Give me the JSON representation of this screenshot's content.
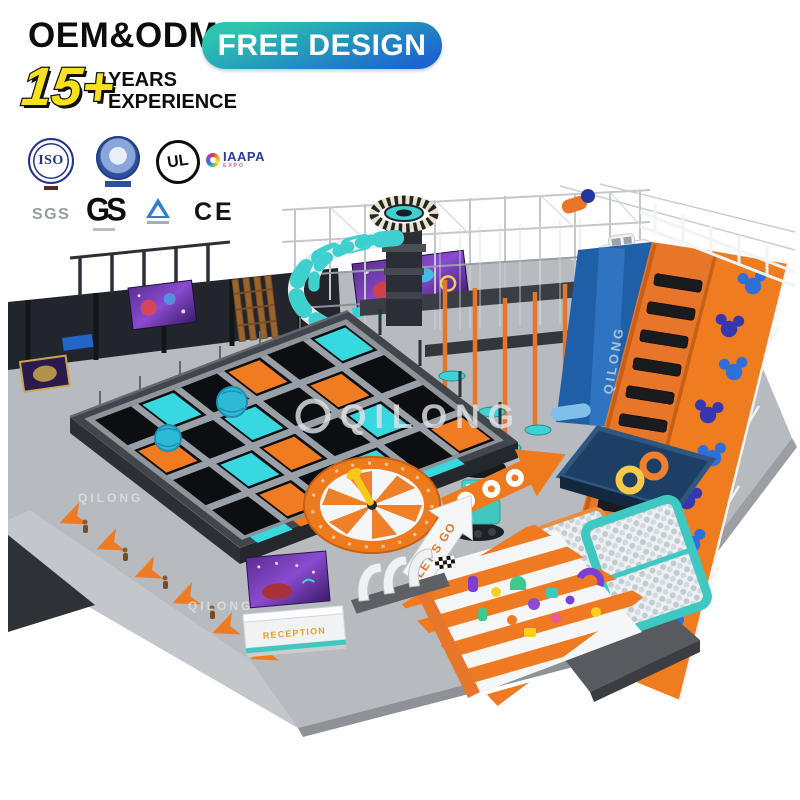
{
  "header": {
    "oem_odm": "OEM&ODM",
    "free_design": "FREE DESIGN",
    "years_number": "15+",
    "years_word": "YEARS",
    "experience_word": "EXPERIENCE",
    "pill_gradient_start": "#2cc4ae",
    "pill_gradient_end": "#1e66cf",
    "years_number_color": "#f6e11c"
  },
  "certifications": {
    "row1": [
      {
        "id": "iso",
        "label": "ISO"
      },
      {
        "id": "quality-seal",
        "label": ""
      },
      {
        "id": "ul",
        "label": "UL"
      },
      {
        "id": "iaapa",
        "label": "IAAPA",
        "sublabel": "EXPO"
      }
    ],
    "row2": [
      {
        "id": "sgs",
        "label": "SGS"
      },
      {
        "id": "gs",
        "label": "GS"
      },
      {
        "id": "tuv",
        "label": ""
      },
      {
        "id": "ce",
        "label": "CE"
      }
    ]
  },
  "playground": {
    "watermark": "QILONG",
    "lets_go_sign": "LET'S GO",
    "reception_sign": "RECEPTION",
    "colors": {
      "teal": "#3ecfcf",
      "orange": "#f07a21",
      "slide_blue": "#1e5fa8",
      "mickey_blue": "#2f6fd8",
      "mickey_dark_blue": "#3537b0",
      "floor_gray": "#b7babe",
      "platform_dark": "#2e3237",
      "wall_black": "#22262c",
      "donut_orange": "#ef8030",
      "donut_yellow": "#f7c948",
      "ballpit_teal": "#3fc8c2",
      "banner_purple": "#5b2d92",
      "spinner_orange": "#ee7a1e",
      "pool_navy": "#1d3f66"
    }
  }
}
